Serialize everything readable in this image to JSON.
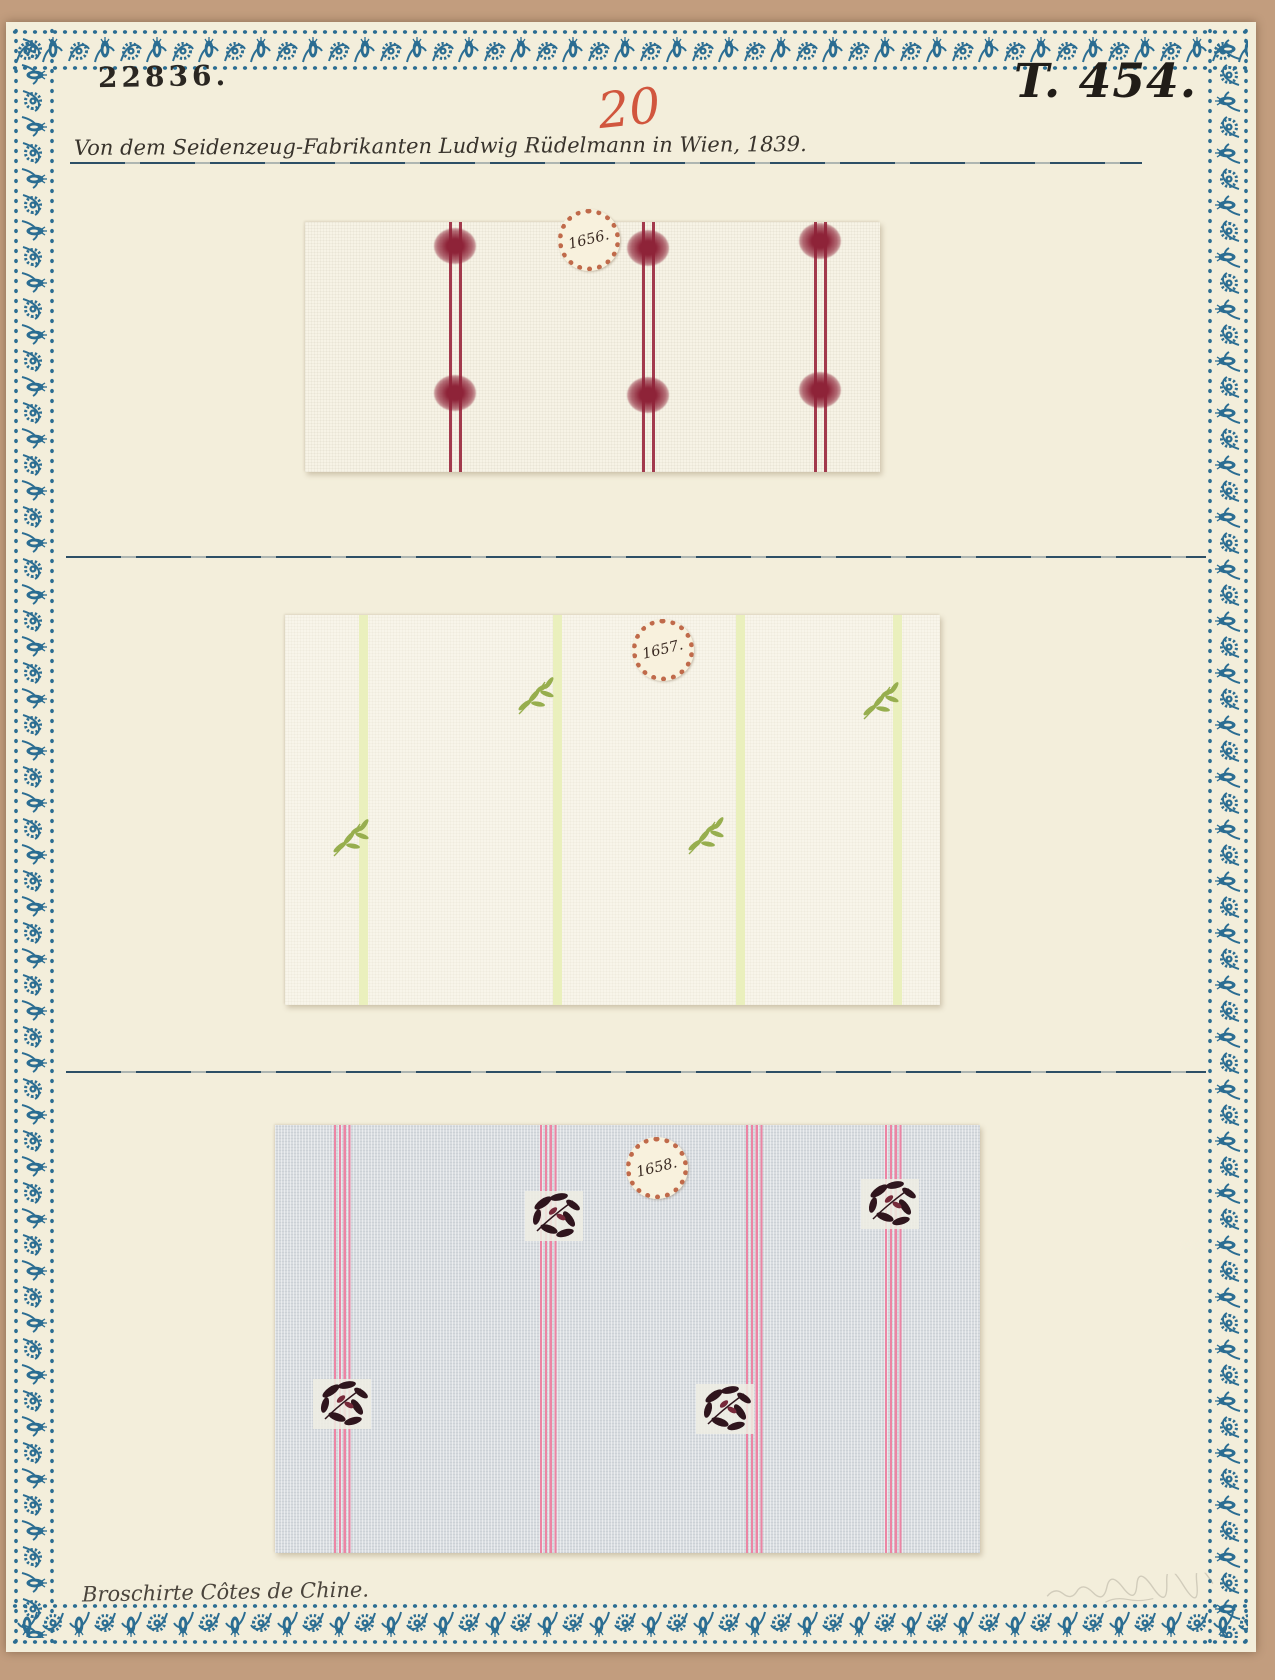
{
  "document": {
    "inventory_number": "22836.",
    "plate_number": "T. 454.",
    "page_number": "20",
    "provenance_line": "Von dem Seidenzeug-Fabrikanten Ludwig Rüdelmann in Wien, 1839.",
    "caption": "Broschirte Côtes de Chine.",
    "swatches": [
      {
        "seal": "1656.",
        "description": "cream silk with double crimson stripes and brocaded red dots"
      },
      {
        "seal": "1657.",
        "description": "white silk with pale yellow-green stripes and green leaf sprigs"
      },
      {
        "seal": "1658.",
        "description": "grey silk with pink pinstripe bands and dark brocaded floral sprigs"
      }
    ]
  },
  "colors": {
    "board": "#c29d7e",
    "page": "#f3eedb",
    "border-blue": "#2b6d92",
    "ink": "#2b2722",
    "red-number": "#cf4a31",
    "rule-blue": "#2d4f66",
    "crimson": "#9c2b41",
    "dot-red": "#8e2338",
    "pale-green": "#e9efbb",
    "leaf-green": "#97ae4e",
    "gray-ground": "#d8dce0",
    "pink-stripe": "#ec85a4",
    "motif-dark": "#2f151d",
    "motif-accent": "#77293a",
    "seal-edge": "#c06a4a",
    "seal-face": "#f8f1dd",
    "seal-ink": "#3a2a22"
  }
}
